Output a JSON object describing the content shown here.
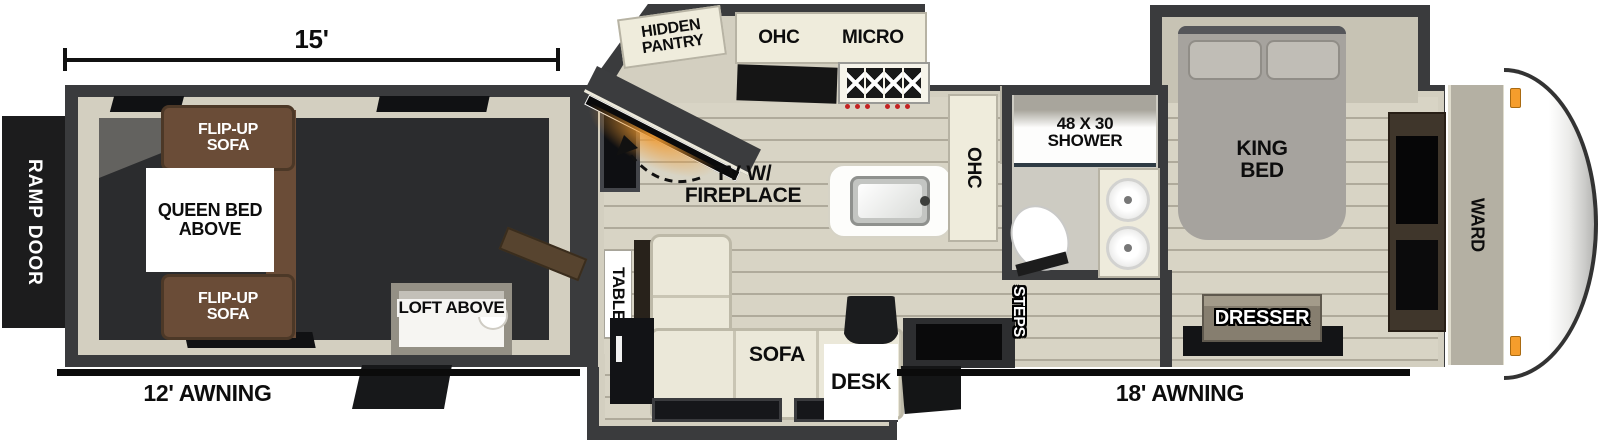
{
  "title": "Travel trailer floor plan",
  "colors": {
    "wall": "#3a3b3d",
    "interior_trim": "#d3cfc0",
    "wood_floor": "#d8d4c5",
    "garage_floor": "#2b2c2e",
    "sofa_brown": "#6a4c37",
    "sectional_cream": "#ebe8d9",
    "bed_gray": "#a6a39e",
    "fireplace_orange": "#f09a30",
    "marker_light_orange": "#f59d2c",
    "label_black": "#0d0d0d",
    "label_white": "#ffffff"
  },
  "dimensions": {
    "garage_length": "15'"
  },
  "garage": {
    "ramp_door": "RAMP DOOR",
    "flip_sofa_top": "FLIP-UP\nSOFA",
    "queen_bed": "QUEEN BED\nABOVE",
    "flip_sofa_bottom": "FLIP-UP\nSOFA",
    "loft": "LOFT ABOVE",
    "awning": "12' AWNING"
  },
  "kitchen": {
    "hidden_pantry": "HIDDEN\nPANTRY",
    "ohc": "OHC",
    "micro": "MICRO",
    "tv_fireplace": "TV W/\nFIREPLACE",
    "ohc_side": "OHC",
    "pantry": "PANTRY"
  },
  "living": {
    "table": "TABLE",
    "sofa": "SOFA",
    "desk": "DESK"
  },
  "bath": {
    "shower": "48 X 30\nSHOWER",
    "steps": "STEPS"
  },
  "bedroom": {
    "king_bed": "KING\nBED",
    "dresser": "DRESSER",
    "ward": "WARD",
    "awning": "18' AWNING"
  }
}
